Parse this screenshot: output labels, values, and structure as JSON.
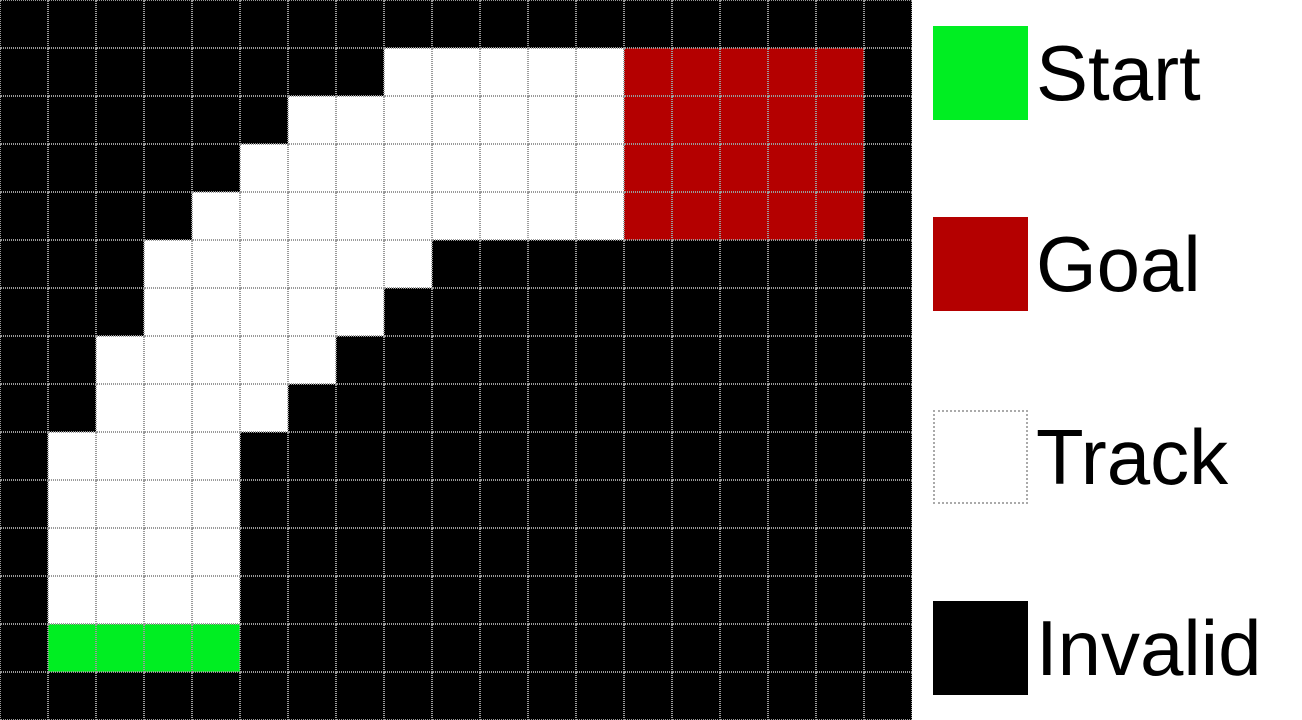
{
  "grid": {
    "rows": 15,
    "cols": 19,
    "cell_size_px": 48,
    "gridline_color": "#9a9a9a",
    "cell_colors": {
      "B": "#000000",
      "W": "#ffffff",
      "R": "#b40000",
      "G": "#00ee22"
    },
    "cell_types": {
      "B": "invalid",
      "W": "track",
      "R": "goal",
      "G": "start"
    },
    "cells": [
      "BBBBBBBBBBBBBBBBBBB",
      "BBBBBBBBWWWWWRRRRRB",
      "BBBBBBWWWWWWWRRRRRB",
      "BBBBBWWWWWWWWRRRRRB",
      "BBBBWWWWWWWWWRRRRRB",
      "BBBWWWWWWBBBBBBBBBB",
      "BBBWWWWWBBBBBBBBBBB",
      "BBWWWWWBBBBBBBBBBBB",
      "BBWWWWBBBBBBBBBBBBB",
      "BWWWWBBBBBBBBBBBBBB",
      "BWWWWBBBBBBBBBBBBBB",
      "BWWWWBBBBBBBBBBBBBB",
      "BWWWWBBBBBBBBBBBBBB",
      "BGGGGBBBBBBBBBBBBBB",
      "BBBBBBBBBBBBBBBBBBB"
    ]
  },
  "legend": {
    "items": [
      {
        "label": "Start",
        "color": "#00ee22",
        "border_color": null
      },
      {
        "label": "Goal",
        "color": "#b40000",
        "border_color": null
      },
      {
        "label": "Track",
        "color": "#ffffff",
        "border_color": "#aaaaaa"
      },
      {
        "label": "Invalid",
        "color": "#000000",
        "border_color": null
      }
    ]
  }
}
